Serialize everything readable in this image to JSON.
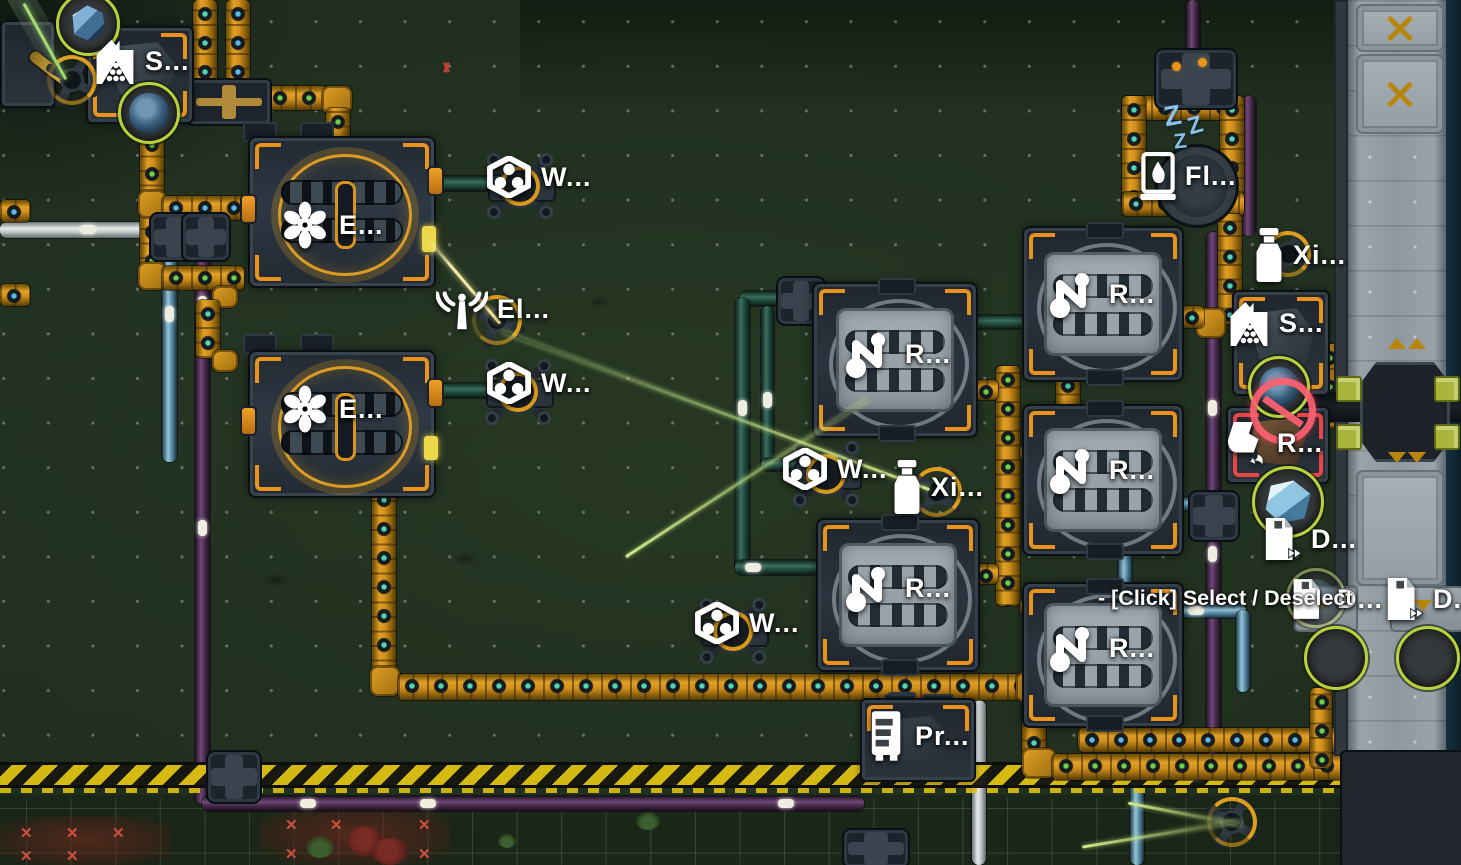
{
  "tooltip": {
    "text": "- [Click] Select / Deselect"
  },
  "markers": {
    "storage": "S...",
    "assembler_e": "E...",
    "wireless_w": "W...",
    "tesla_el": "El...",
    "machine_r": "R...",
    "tower_xi": "Xi...",
    "tower_fl": "Fl...",
    "refinery_r": "R...",
    "doc_d": "D...",
    "processor_pr": "Pr...",
    "sleep_z": "Z"
  },
  "decals": {
    "blocked_x": "✕"
  },
  "palette": {
    "belt_orange": "#e3a026",
    "pipe_teal": "#3a6f5e",
    "pipe_purple": "#6f4876",
    "pipe_blue": "#93c5da",
    "hazard_yellow": "#dec113",
    "label_white": "#ffffff",
    "sleep_blue": "#8cc0ea",
    "vein_ring_green": "#b7d23a",
    "alert_red": "#ff6070",
    "laser_yellow": "#f4ecab",
    "laser_lime": "#cdea86"
  }
}
